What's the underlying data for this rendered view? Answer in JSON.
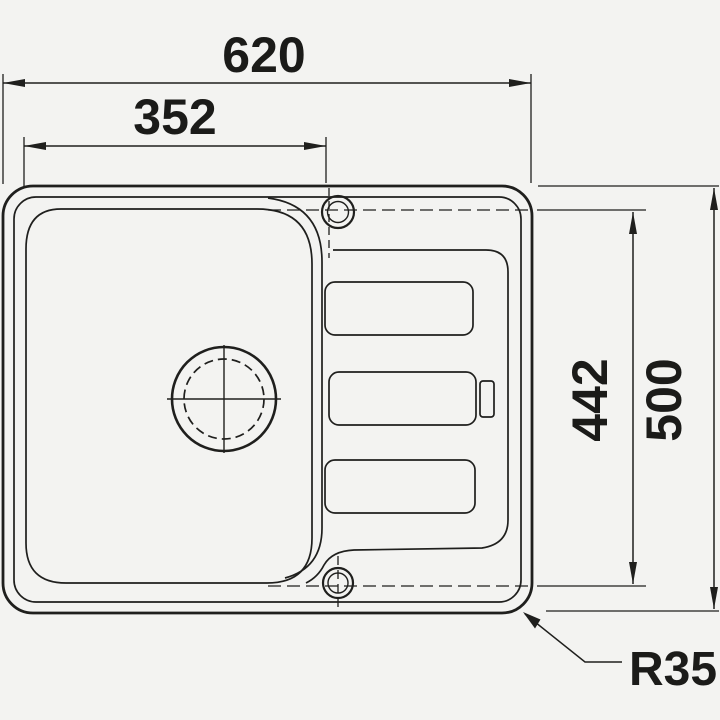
{
  "document": {
    "type": "technical-drawing",
    "subject": "inset kitchen sink with single bowl and drainboard, top view"
  },
  "dimensions": {
    "overall_width": "620",
    "bowl_width": "352",
    "hole_span_depth": "442",
    "overall_depth": "500",
    "corner_radius": "R35"
  },
  "colors": {
    "ink": "#1f1f1d",
    "paper": "#f3f3f1"
  }
}
